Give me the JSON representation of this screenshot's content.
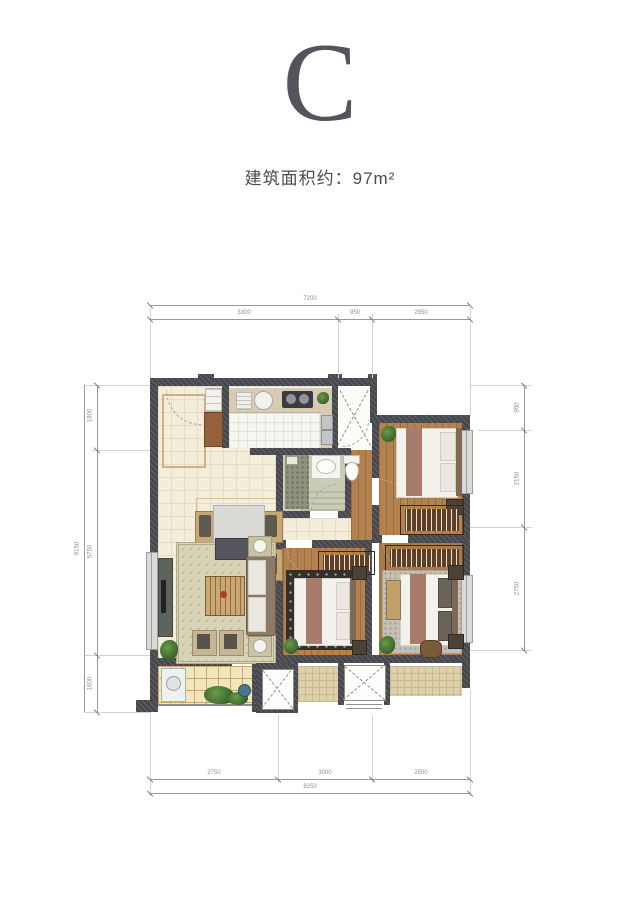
{
  "header": {
    "unit_letter": "C",
    "area_label": "建筑面积约：97m²"
  },
  "dimensions": {
    "top": {
      "total": "7200",
      "segments": [
        "3300",
        "950",
        "2950"
      ]
    },
    "bottom": {
      "total": "8250",
      "segments": [
        "2750",
        "3000",
        "2500"
      ]
    },
    "left": {
      "total": "9150",
      "segments": [
        "1800",
        "5750",
        "1600"
      ]
    },
    "right": {
      "segments": [
        "950",
        "2150",
        "2750"
      ]
    }
  },
  "colors": {
    "title": "#53545c",
    "wall": "#47474e",
    "tile_floor": "#f4edda",
    "wood_floor": "#b3824f",
    "balcony_floor": "#f0e5bb",
    "bath_floor": "#caccb6",
    "plant_green": "#4a7a37"
  }
}
